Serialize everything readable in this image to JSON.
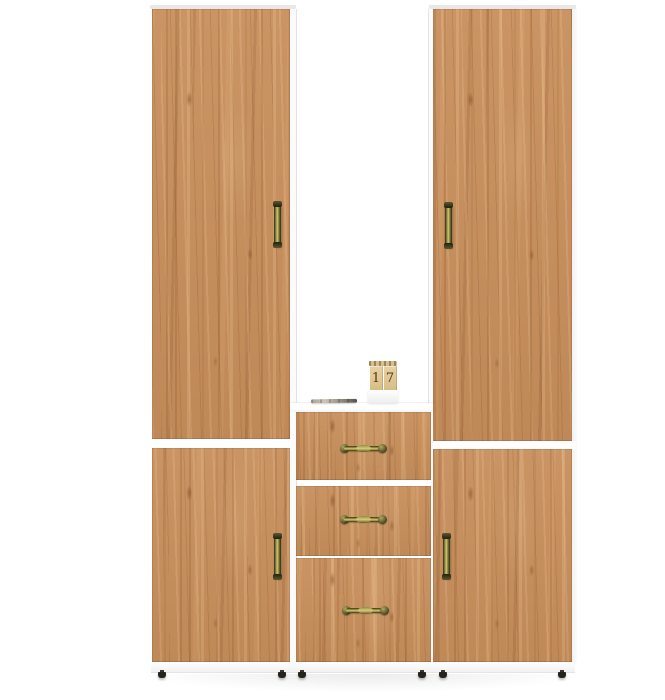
{
  "image": {
    "kind": "furniture product photo",
    "subject": "wardrobe set with central drawer unit and open shelf niche",
    "background_color": "#ffffff"
  },
  "palette": {
    "wood_base": "#c78e5b",
    "wood_dark_streak": "#a5703c",
    "wood_light_streak": "#ecc18e",
    "carcass_white": "#ffffff",
    "top_edge_gray": "#e8e8e8",
    "handle_brass": "#9a9347",
    "handle_dark": "#23210f",
    "feet_black": "#26221d"
  },
  "calendar": {
    "digit_left": "1",
    "digit_right": "7"
  },
  "structure": {
    "tall_wardrobe_doors": 2,
    "lower_cabinet_doors": 2,
    "drawers": 3,
    "feet": 6,
    "shelf_items": [
      "pen",
      "wooden block calendar"
    ]
  }
}
